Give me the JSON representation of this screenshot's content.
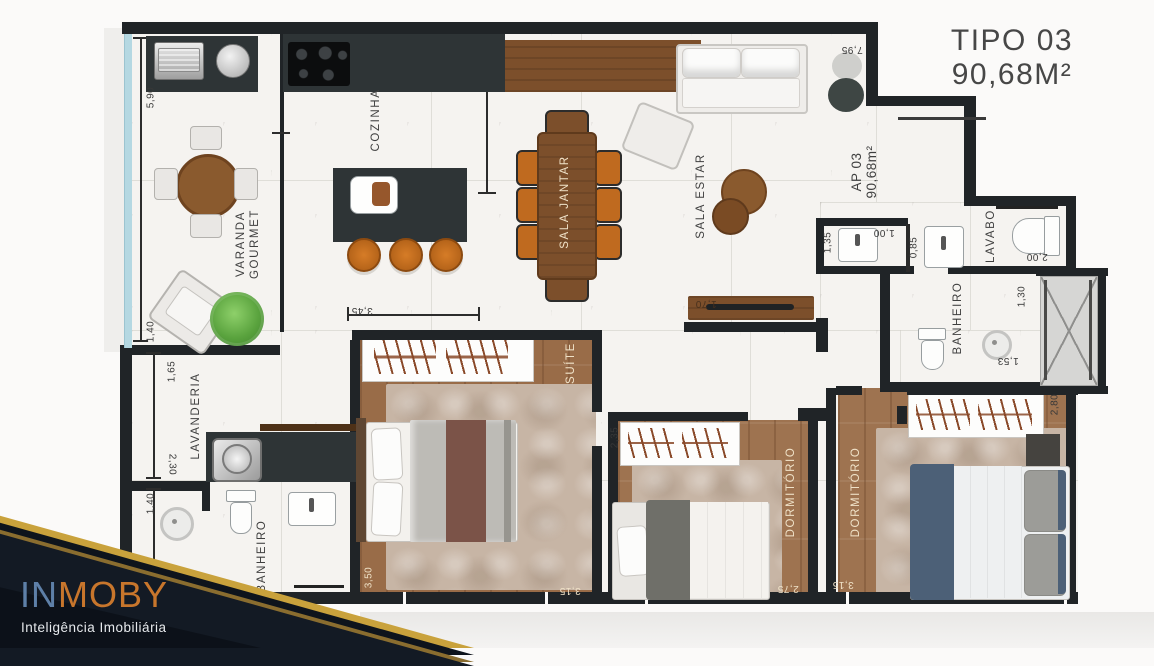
{
  "title": {
    "model": "TIPO 03",
    "area": "90,68M²"
  },
  "unit": {
    "name": "AP 03",
    "area": "90,68m²"
  },
  "logo": {
    "brand_blue": "IN",
    "brand_orange": "MOBY",
    "tagline": "Inteligência Imobiliária"
  },
  "labels": {
    "cozinha": "COZINHA",
    "varanda_line1": "VARANDA",
    "varanda_line2": "GOURMET",
    "sala_jantar": "SALA JANTAR",
    "sala_estar": "SALA ESTAR",
    "lavanderia": "LAVANDERIA",
    "banheiro_social": "BANHEIRO",
    "banheiro_suite": "BANHEIRO",
    "lavabo": "LAVABO",
    "suite": "SUÍTE",
    "dormitorio_2": "DORMITÓRIO",
    "dormitorio_3": "DORMITÓRIO"
  },
  "dims": {
    "varanda_h": "5,90",
    "varanda_w": "1,40",
    "lavanderia_h": "1,65",
    "lavanderia_w": "2,30",
    "banheiro_social_w": "1,40",
    "banheiro_social_h": "2,70",
    "cozinha_w": "3,45",
    "suite_w": "3,50",
    "suite_d": "3,15",
    "dorm2_d": "2,35",
    "dorm2_w": "2,75",
    "dorm3_w": "3,15",
    "dorm3_d": "2,80",
    "sala_w": "7,95",
    "tv_wall": "1,70",
    "hall_a": "1,35",
    "hall_b": "1,00",
    "hall_c": "0,85",
    "lavabo_w": "2,00",
    "banheiro_suite_a": "1,30",
    "banheiro_suite_b": "1,53"
  },
  "colors": {
    "wall": "#202427",
    "wood_floor": "#9e7350",
    "wood_furniture": "#7c4f2b",
    "counter_dark": "#2e3436",
    "chair_orange": "#bf6a1f",
    "glass_blue": "#b5d8e2",
    "logo_blue": "#5e80a8",
    "logo_orange": "#c8762c",
    "logo_gold": "#c9a23c",
    "logo_bg": "#131a24"
  }
}
